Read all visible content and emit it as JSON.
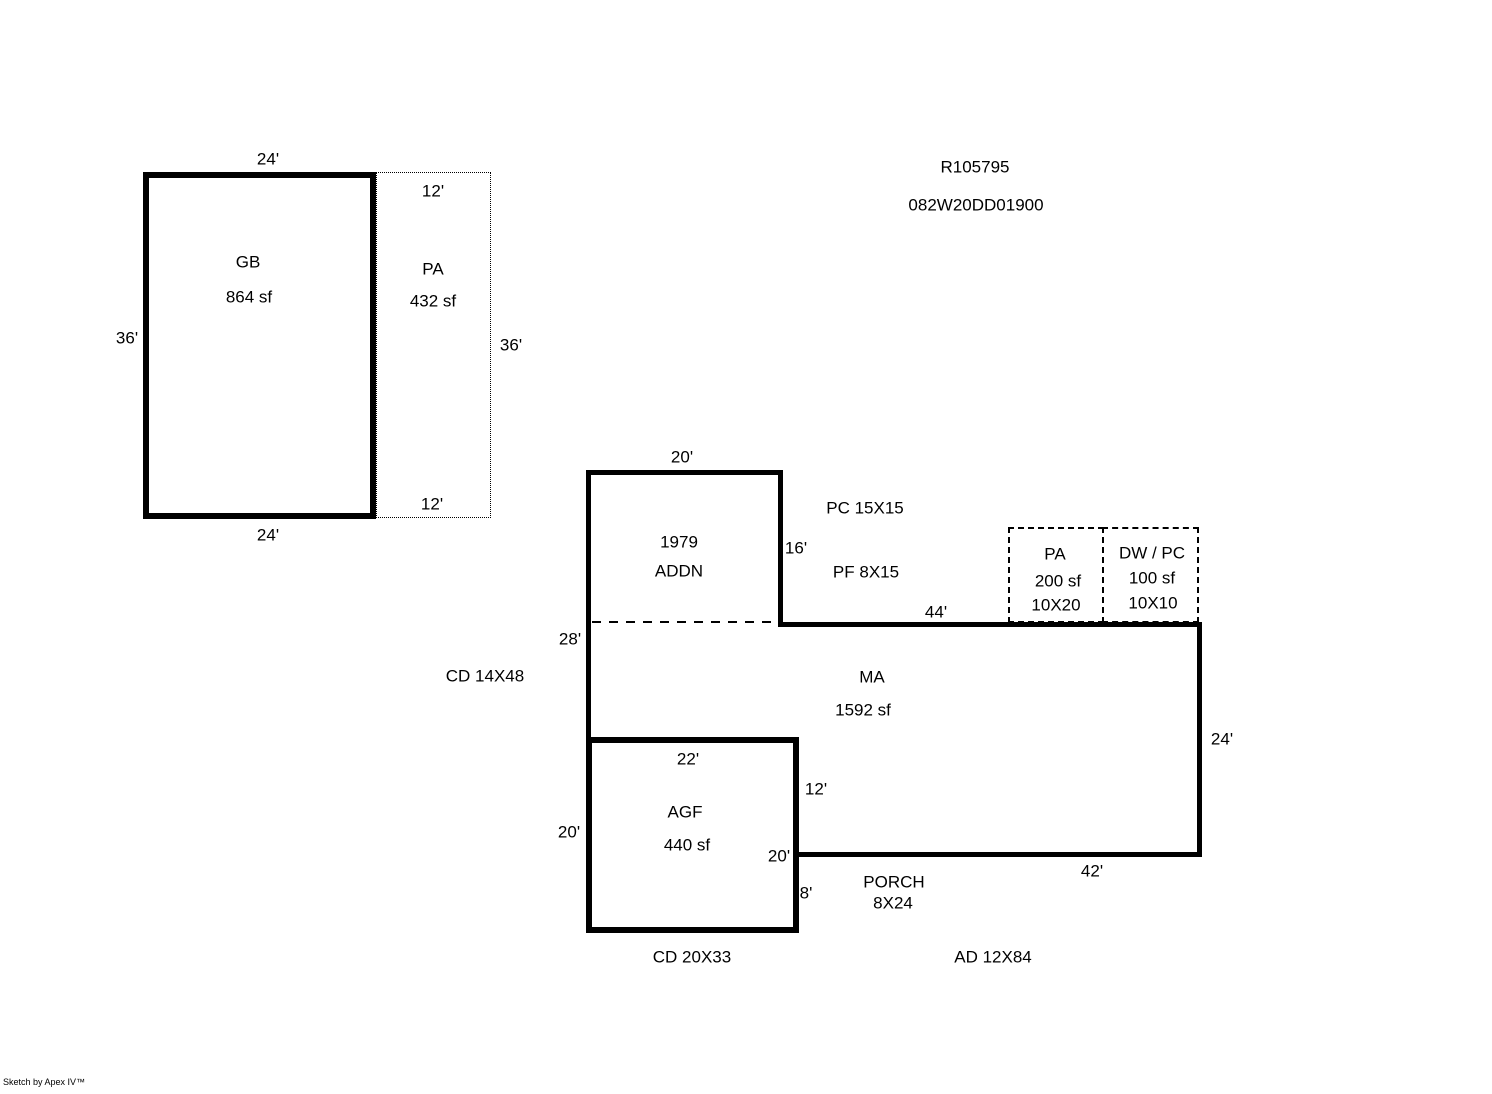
{
  "header": {
    "record_id": "R105795",
    "parcel_id": "082W20DD01900"
  },
  "garage": {
    "label": "GB",
    "area": "864 sf",
    "dim_top": "24'",
    "dim_left": "36'",
    "dim_bottom": "24'"
  },
  "patio_left": {
    "label": "PA",
    "area": "432 sf",
    "dim_top": "12'",
    "dim_right": "36'",
    "dim_bottom": "12'"
  },
  "addition": {
    "year": "1979",
    "label": "ADDN",
    "dim_top": "20'",
    "dim_right": "16'"
  },
  "main_area": {
    "label": "MA",
    "area": "1592 sf",
    "dim_top": "44'",
    "dim_left": "28'",
    "dim_right": "24'",
    "dim_bottom": "42'",
    "dim_notch": "12'"
  },
  "patio_right": {
    "label": "PA",
    "area": "200 sf",
    "dim": "10X20"
  },
  "deck": {
    "label": "DW / PC",
    "area": "100 sf",
    "dim": "10X10"
  },
  "garage_finished": {
    "label": "AGF",
    "area": "440 sf",
    "dim_top": "22'",
    "dim_left": "20'",
    "dim_right": "20'",
    "dim_porch_side": "8'"
  },
  "porch": {
    "label": "PORCH",
    "dim": "8X24"
  },
  "notes": {
    "pc": "PC 15X15",
    "pf": "PF 8X15",
    "cd_upper": "CD 14X48",
    "cd_lower": "CD 20X33",
    "ad": "AD 12X84"
  },
  "footer": {
    "watermark": "Sketch by Apex IV™"
  }
}
